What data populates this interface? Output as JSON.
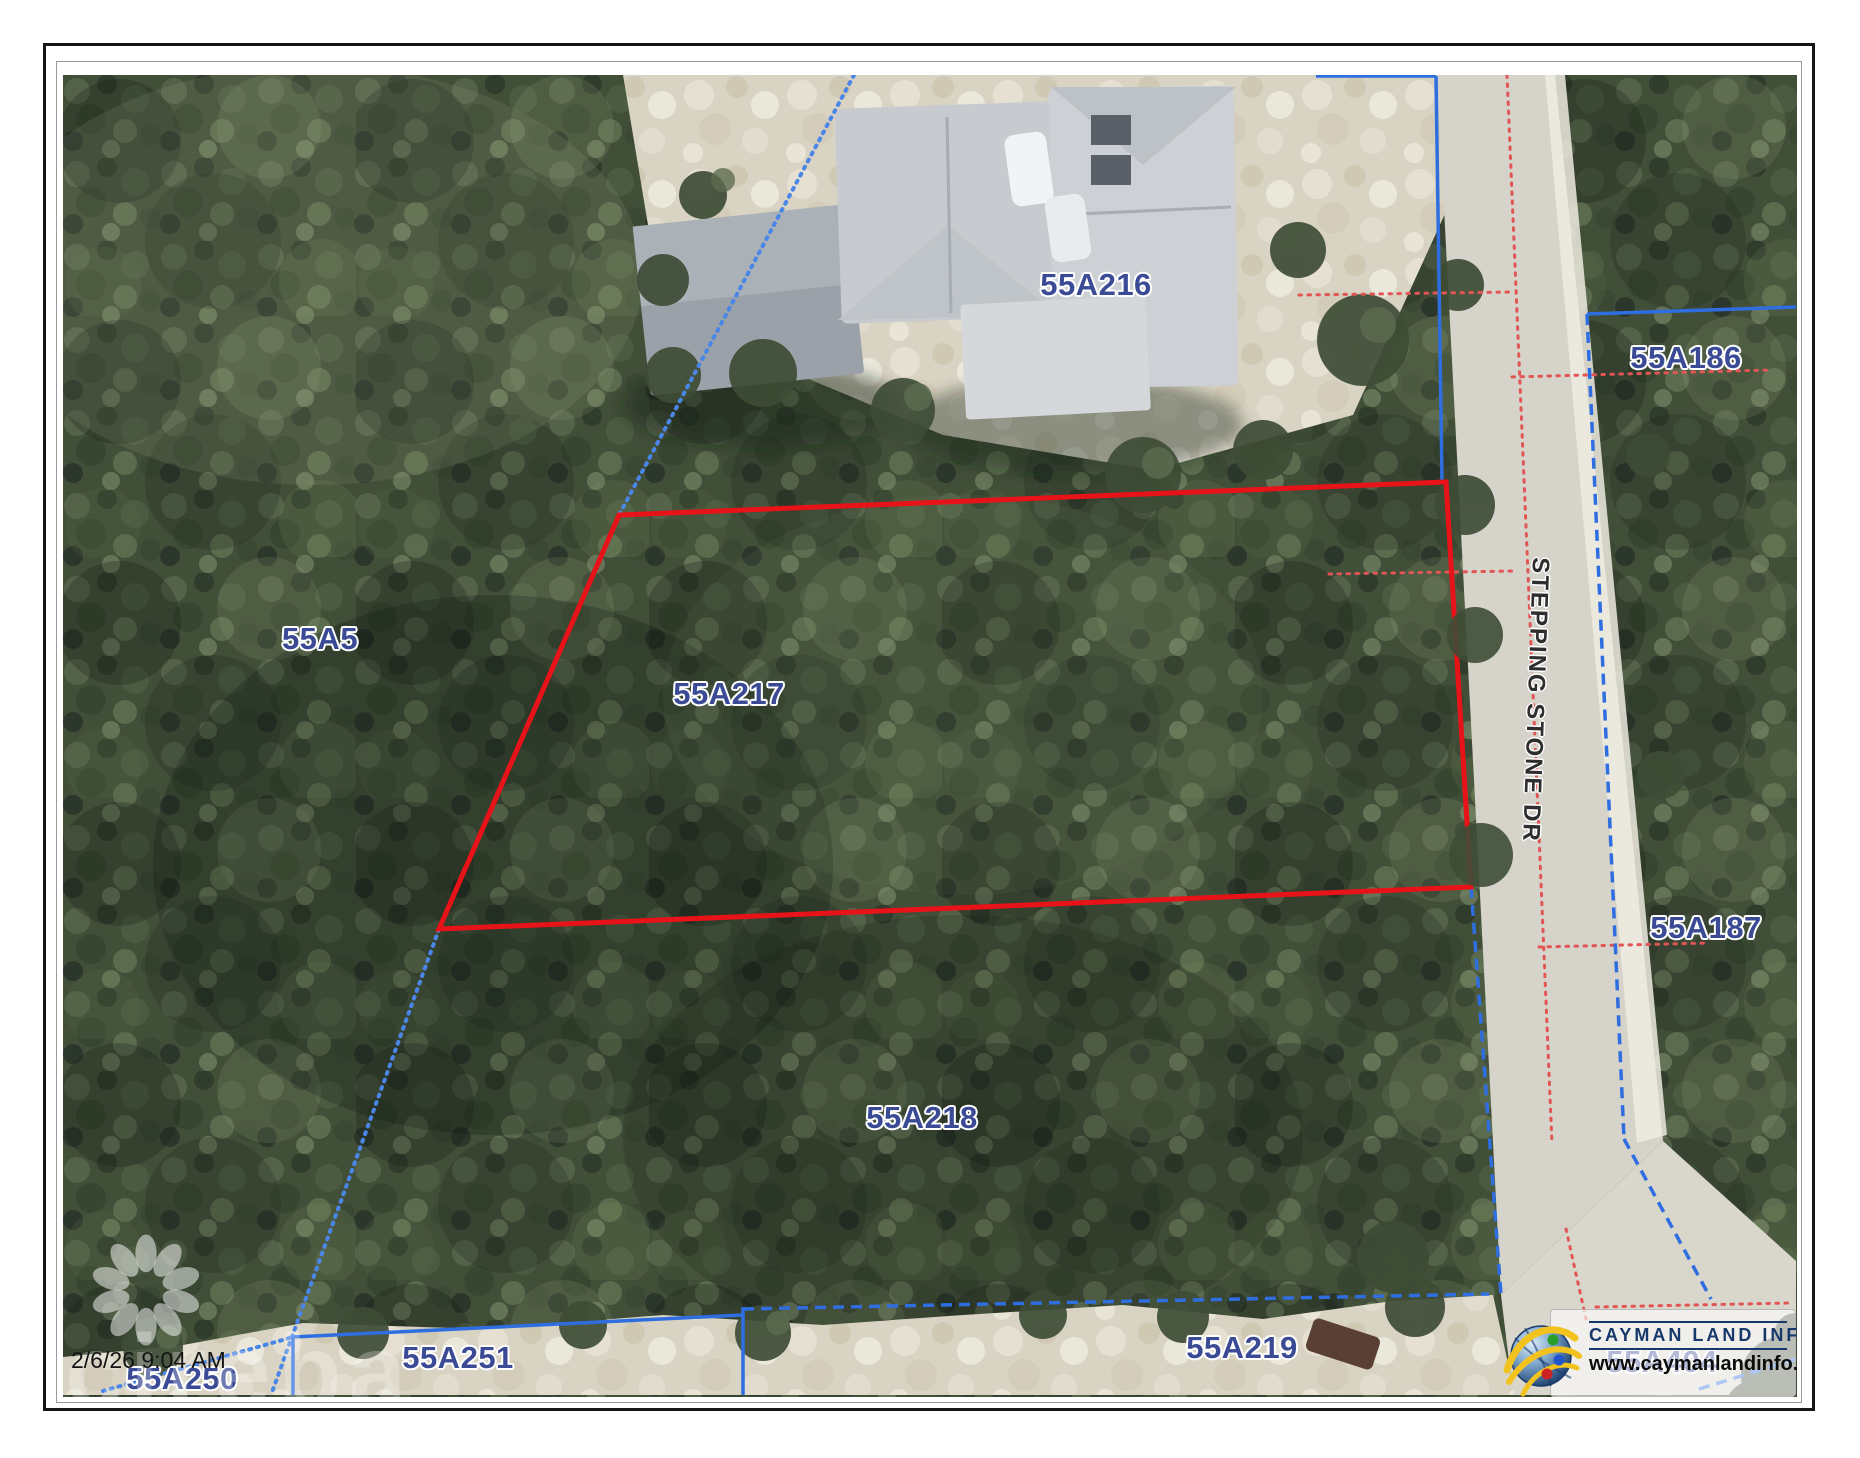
{
  "map": {
    "timestamp": "2/6/26 9:04 AM",
    "street_label": "STEPPING STONE DR",
    "highlighted_parcel": "55A217",
    "parcel_labels": [
      {
        "id": "55A216",
        "x": 1033,
        "y": 210
      },
      {
        "id": "55A5",
        "x": 257,
        "y": 564
      },
      {
        "id": "55A217",
        "x": 666,
        "y": 619
      },
      {
        "id": "55A218",
        "x": 859,
        "y": 1043
      },
      {
        "id": "55A219",
        "x": 1179,
        "y": 1273
      },
      {
        "id": "55A250",
        "x": 119,
        "y": 1304
      },
      {
        "id": "55A251",
        "x": 395,
        "y": 1283
      },
      {
        "id": "55A186",
        "x": 1623,
        "y": 283
      },
      {
        "id": "55A187",
        "x": 1643,
        "y": 853
      },
      {
        "id": "55A404",
        "x": 1599,
        "y": 1287
      }
    ]
  },
  "watermark": {
    "brand": "cireba"
  },
  "logo": {
    "title": "CAYMAN LAND INFO",
    "website": "www.caymanlandinfo.ky"
  },
  "colors": {
    "parcel_label": "#3b4a94",
    "highlight_boundary": "#e81318",
    "cadastral_blue": "#2e6ee0",
    "road_reservation_dotted": "#e25555",
    "street_text": "#2e2e2e"
  }
}
